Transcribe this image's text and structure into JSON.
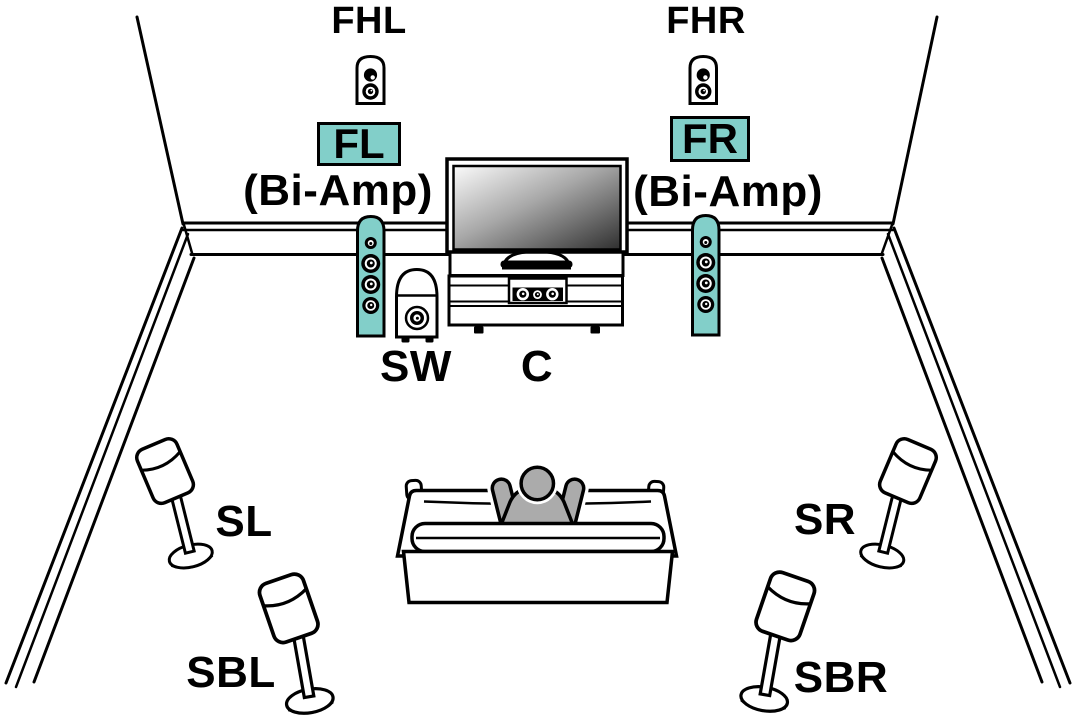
{
  "diagram": {
    "accent_color": "#82CFC9",
    "labels": {
      "front_height_left": "FHL",
      "front_height_right": "FHR",
      "front_left": "FL",
      "front_right": "FR",
      "bi_amp_left": "(Bi-Amp)",
      "bi_amp_right": "(Bi-Amp)",
      "subwoofer": "SW",
      "center": "C",
      "surround_left": "SL",
      "surround_right": "SR",
      "surround_back_left": "SBL",
      "surround_back_right": "SBR"
    }
  }
}
